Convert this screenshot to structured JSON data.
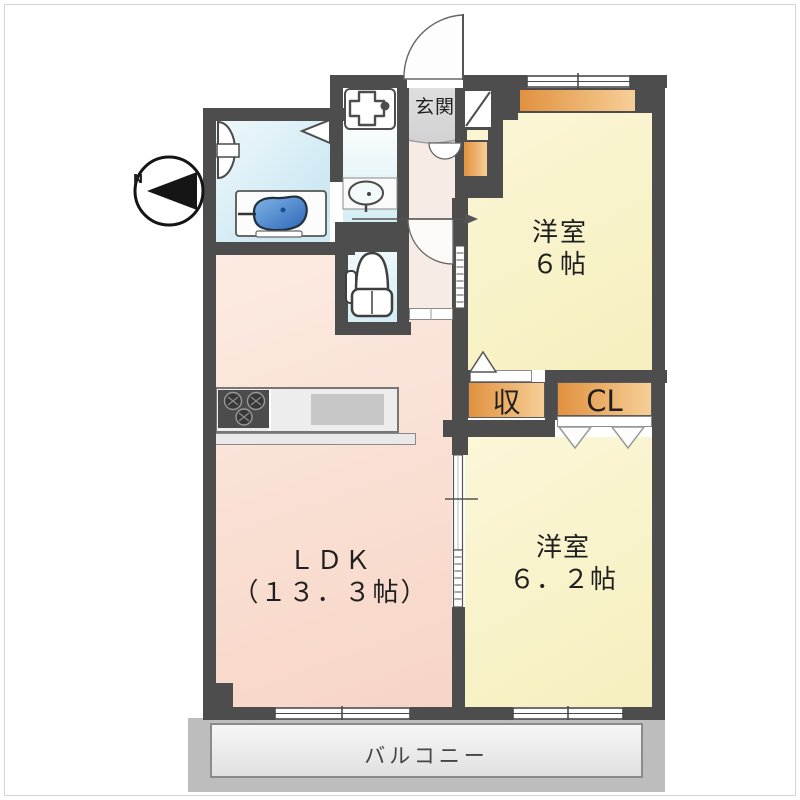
{
  "plan": {
    "compass_label": "N",
    "entrance_label": "玄関",
    "bedroom1": {
      "name": "洋室",
      "size": "６帖"
    },
    "bedroom2": {
      "name": "洋室",
      "size": "６．２帖"
    },
    "ldk": {
      "name": "ＬＤＫ",
      "size": "（１３．３帖）"
    },
    "storage_label": "収",
    "closet_label": "CL",
    "balcony_label": "バルコニー"
  },
  "colors": {
    "wall": "#4d4d4d",
    "bedroom_yellow": "#f8f3c6",
    "ldk_pink": "#f9ddd0",
    "water_cyan": "#d5edf4",
    "hallway_beige": "#f6ece5",
    "genkan_gray": "#d9d9d9",
    "closet_orange_dark": "#e1913f",
    "closet_orange_light": "#f6cf97",
    "bathtub_blue": "#3c78c8",
    "balcony_gray": "#bdbdbd"
  },
  "icons": {
    "compass": "compass-icon",
    "bathtub": "bathtub-icon",
    "bath_vanity": "vanity-icon",
    "washer_pan": "washer-pan-icon",
    "washbasin": "washbasin-icon",
    "toilet": "toilet-icon",
    "stove": "stove-icon",
    "kitchen_sink": "kitchen-sink-icon",
    "shoe_cabinet": "shoe-cabinet-icon",
    "door_swing": "door-arc-icon",
    "sliding_door": "sliding-door-icon",
    "window": "window-icon"
  }
}
